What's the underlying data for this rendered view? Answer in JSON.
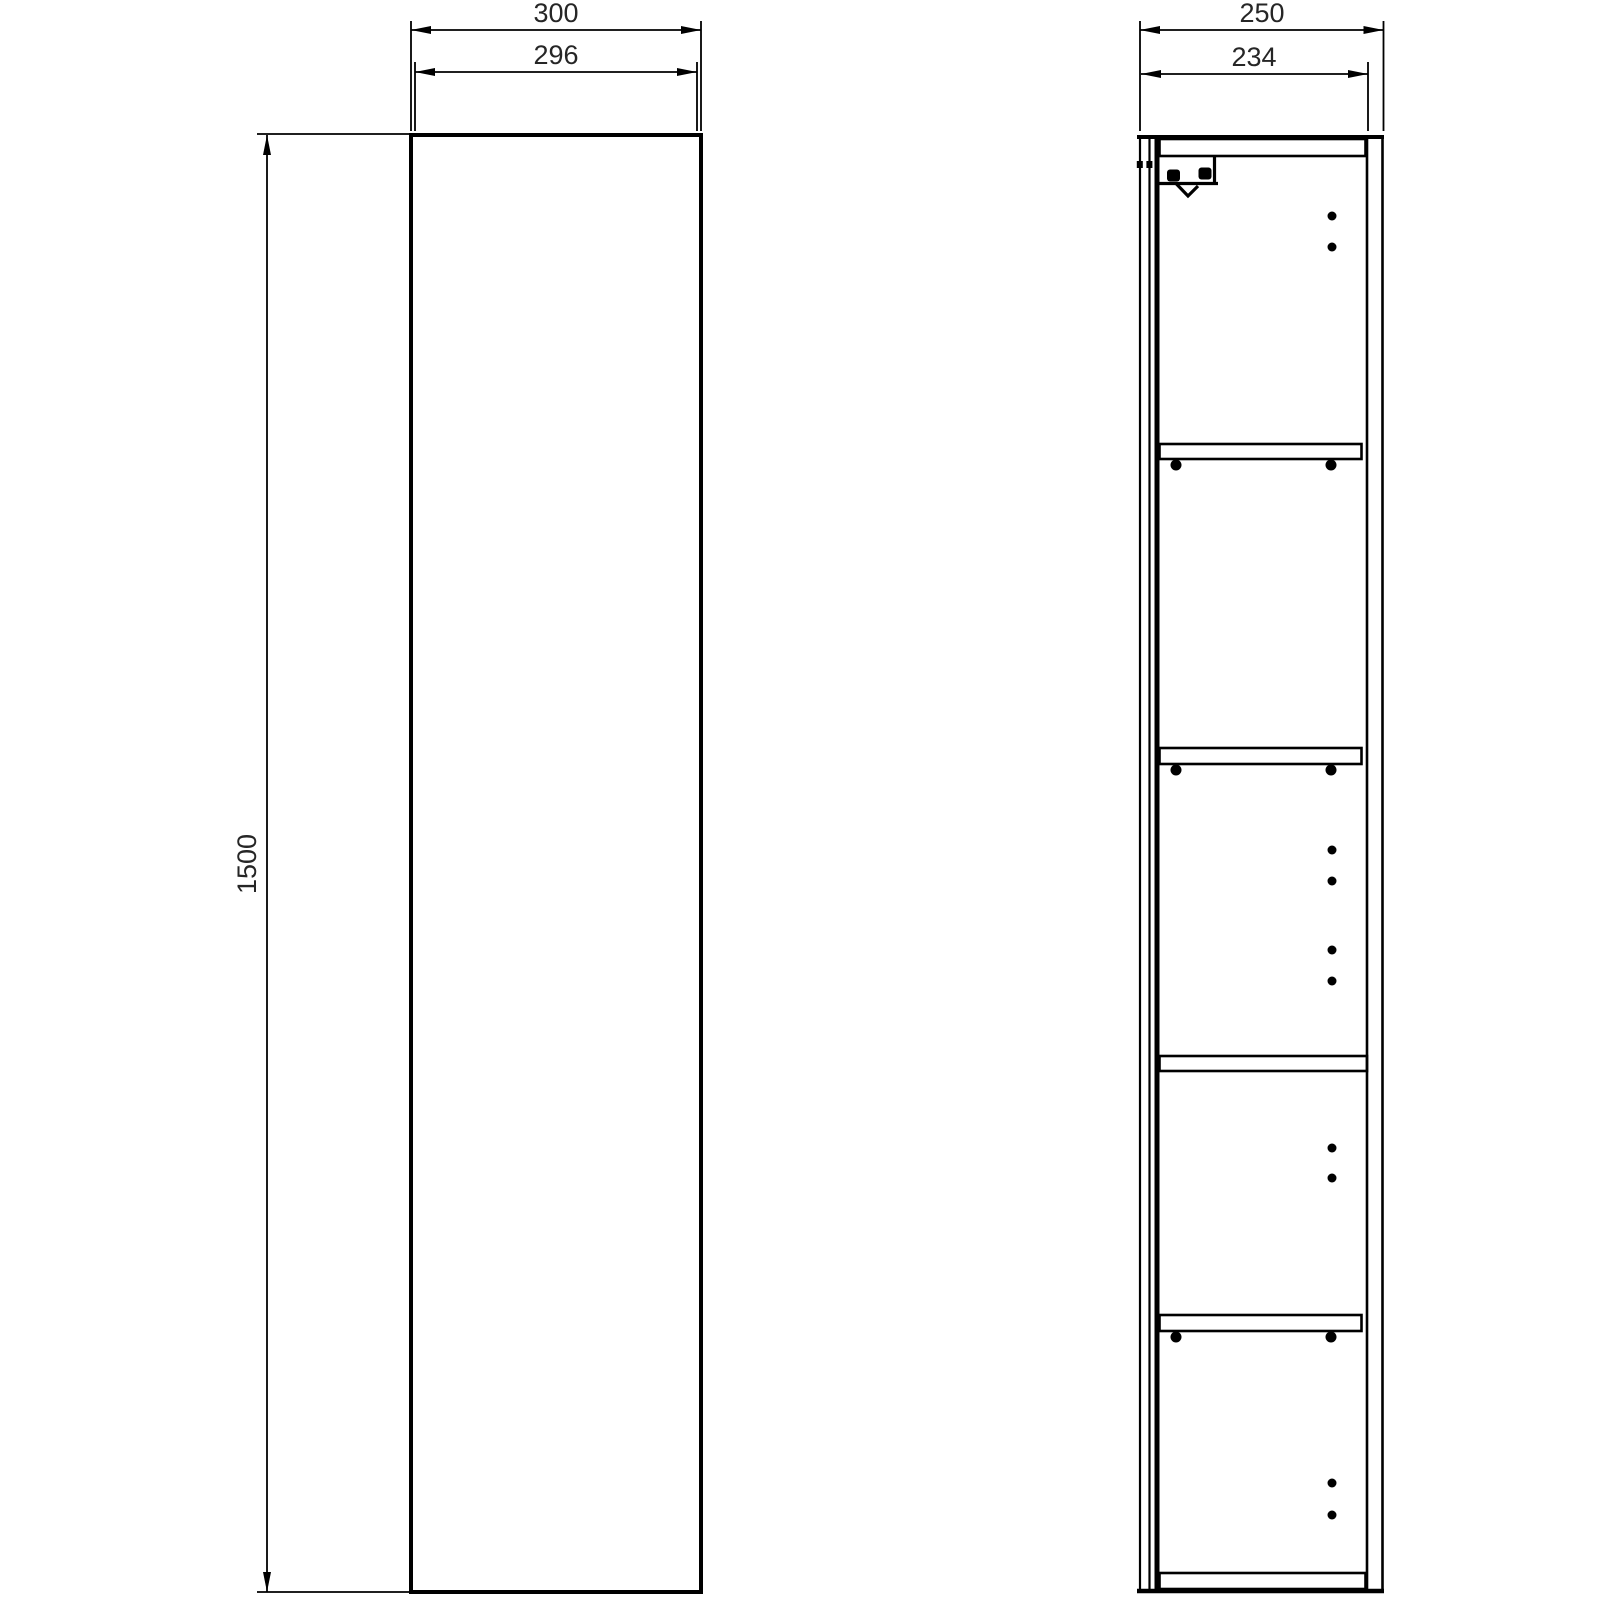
{
  "page": {
    "background": "#ffffff",
    "line_color": "#000000",
    "text_color": "#262626"
  },
  "drawing": {
    "type": "furniture technical drawing",
    "subject": "tall cabinet column - front elevation and side section",
    "front_view": {
      "overall_width_label": "300",
      "door_width_label": "296",
      "height_label": "1500"
    },
    "side_view": {
      "overall_depth_label": "250",
      "internal_depth_label": "234",
      "shelf_count": 4,
      "adjustable_shelf_count": 3,
      "fixed_shelf_count": 1
    }
  }
}
